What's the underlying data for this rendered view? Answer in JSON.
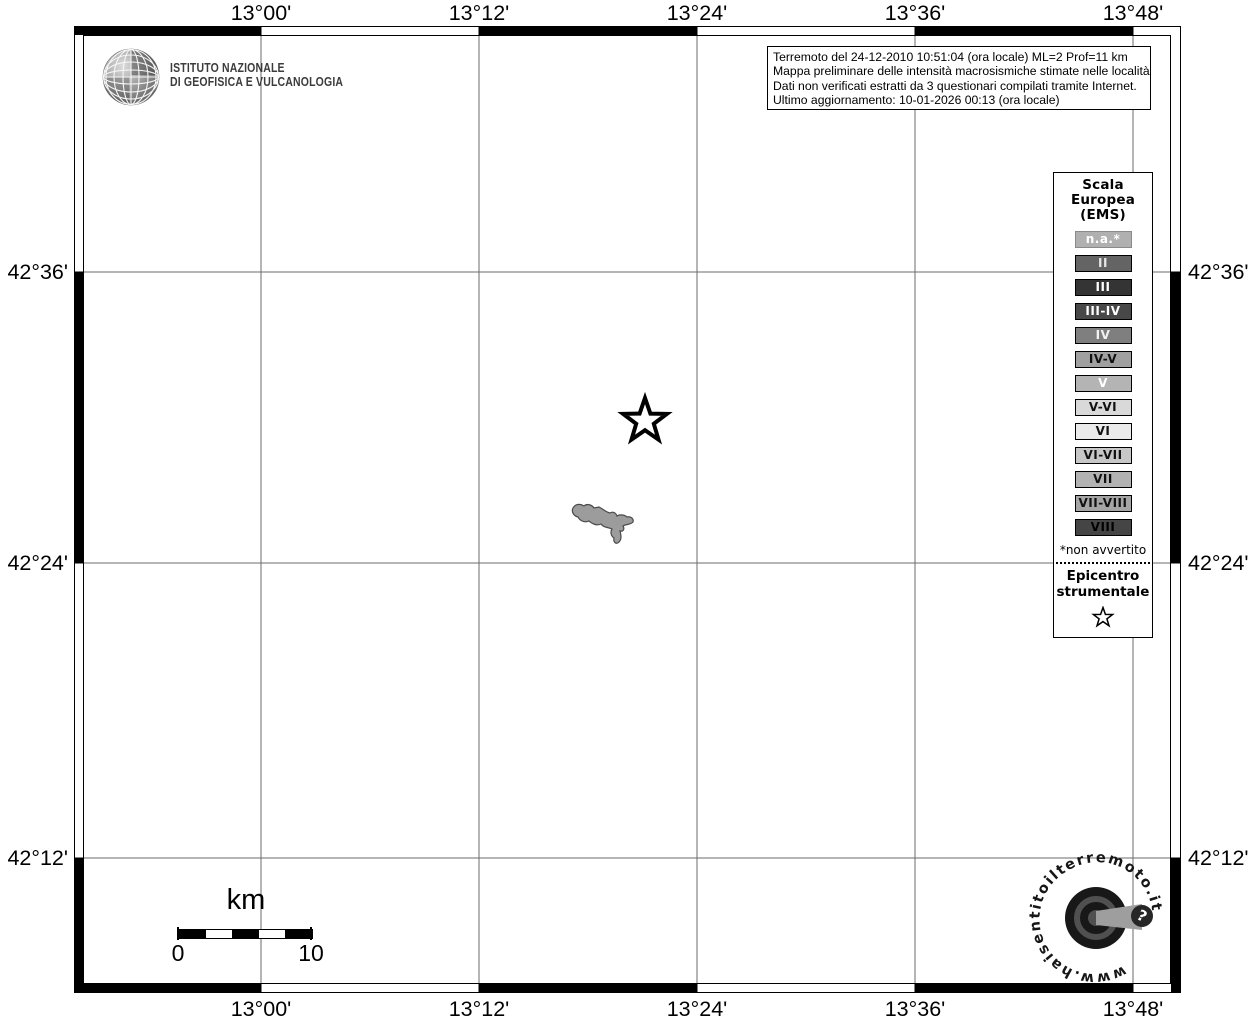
{
  "axes": {
    "top": [
      "13°00'",
      "13°12'",
      "13°24'",
      "13°36'",
      "13°48'"
    ],
    "bottom": [
      "13°00'",
      "13°12'",
      "13°24'",
      "13°36'",
      "13°48'"
    ],
    "left": [
      "42°36'",
      "42°24'",
      "42°12'"
    ],
    "right": [
      "42°36'",
      "42°24'",
      "42°12'"
    ]
  },
  "institute": {
    "line1": "ISTITUTO NAZIONALE",
    "line2": "DI GEOFISICA E VULCANOLOGIA"
  },
  "info": {
    "lines": [
      "Terremoto del 24-12-2010 10:51:04 (ora locale) ML=2 Prof=11 km",
      "Mappa preliminare delle intensità macrosismiche stimate nelle località",
      "Dati non verificati estratti da 3 questionari compilati tramite Internet.",
      "Ultimo aggiornamento: 10-01-2026 00:13 (ora locale)"
    ]
  },
  "legend": {
    "title_lines": [
      "Scala",
      "Europea",
      "(EMS)"
    ],
    "items": [
      {
        "label": "n.a.*",
        "bg": "#b0b0b0",
        "fg": "#ffffff",
        "border": "#8a8a8a"
      },
      {
        "label": "II",
        "bg": "#646464",
        "fg": "#e6e6e6",
        "border": "#000000"
      },
      {
        "label": "III",
        "bg": "#343434",
        "fg": "#ffffff",
        "border": "#000000"
      },
      {
        "label": "III-IV",
        "bg": "#484848",
        "fg": "#ffffff",
        "border": "#000000"
      },
      {
        "label": "IV",
        "bg": "#7f7f7f",
        "fg": "#f2f2f2",
        "border": "#000000"
      },
      {
        "label": "IV-V",
        "bg": "#a0a0a0",
        "fg": "#111111",
        "border": "#000000"
      },
      {
        "label": "V",
        "bg": "#b4b4b4",
        "fg": "#ffffff",
        "border": "#000000"
      },
      {
        "label": "V-VI",
        "bg": "#d9d9d9",
        "fg": "#111111",
        "border": "#000000"
      },
      {
        "label": "VI",
        "bg": "#ebebeb",
        "fg": "#111111",
        "border": "#000000"
      },
      {
        "label": "VI-VII",
        "bg": "#c7c7c7",
        "fg": "#111111",
        "border": "#000000"
      },
      {
        "label": "VII",
        "bg": "#b2b2b2",
        "fg": "#111111",
        "border": "#000000"
      },
      {
        "label": "VII-VIII",
        "bg": "#a5a5a5",
        "fg": "#111111",
        "border": "#000000"
      },
      {
        "label": "VIII",
        "bg": "#454545",
        "fg": "#000000",
        "border": "#000000"
      }
    ],
    "footnote": "*non avvertito",
    "epicenter_lines": [
      "Epicentro",
      "strumentale"
    ]
  },
  "scalebar": {
    "unit": "km",
    "start": "0",
    "end": "10"
  },
  "watermark": {
    "url": "www.haisentitoilterremoto.it",
    "badge": "?"
  }
}
